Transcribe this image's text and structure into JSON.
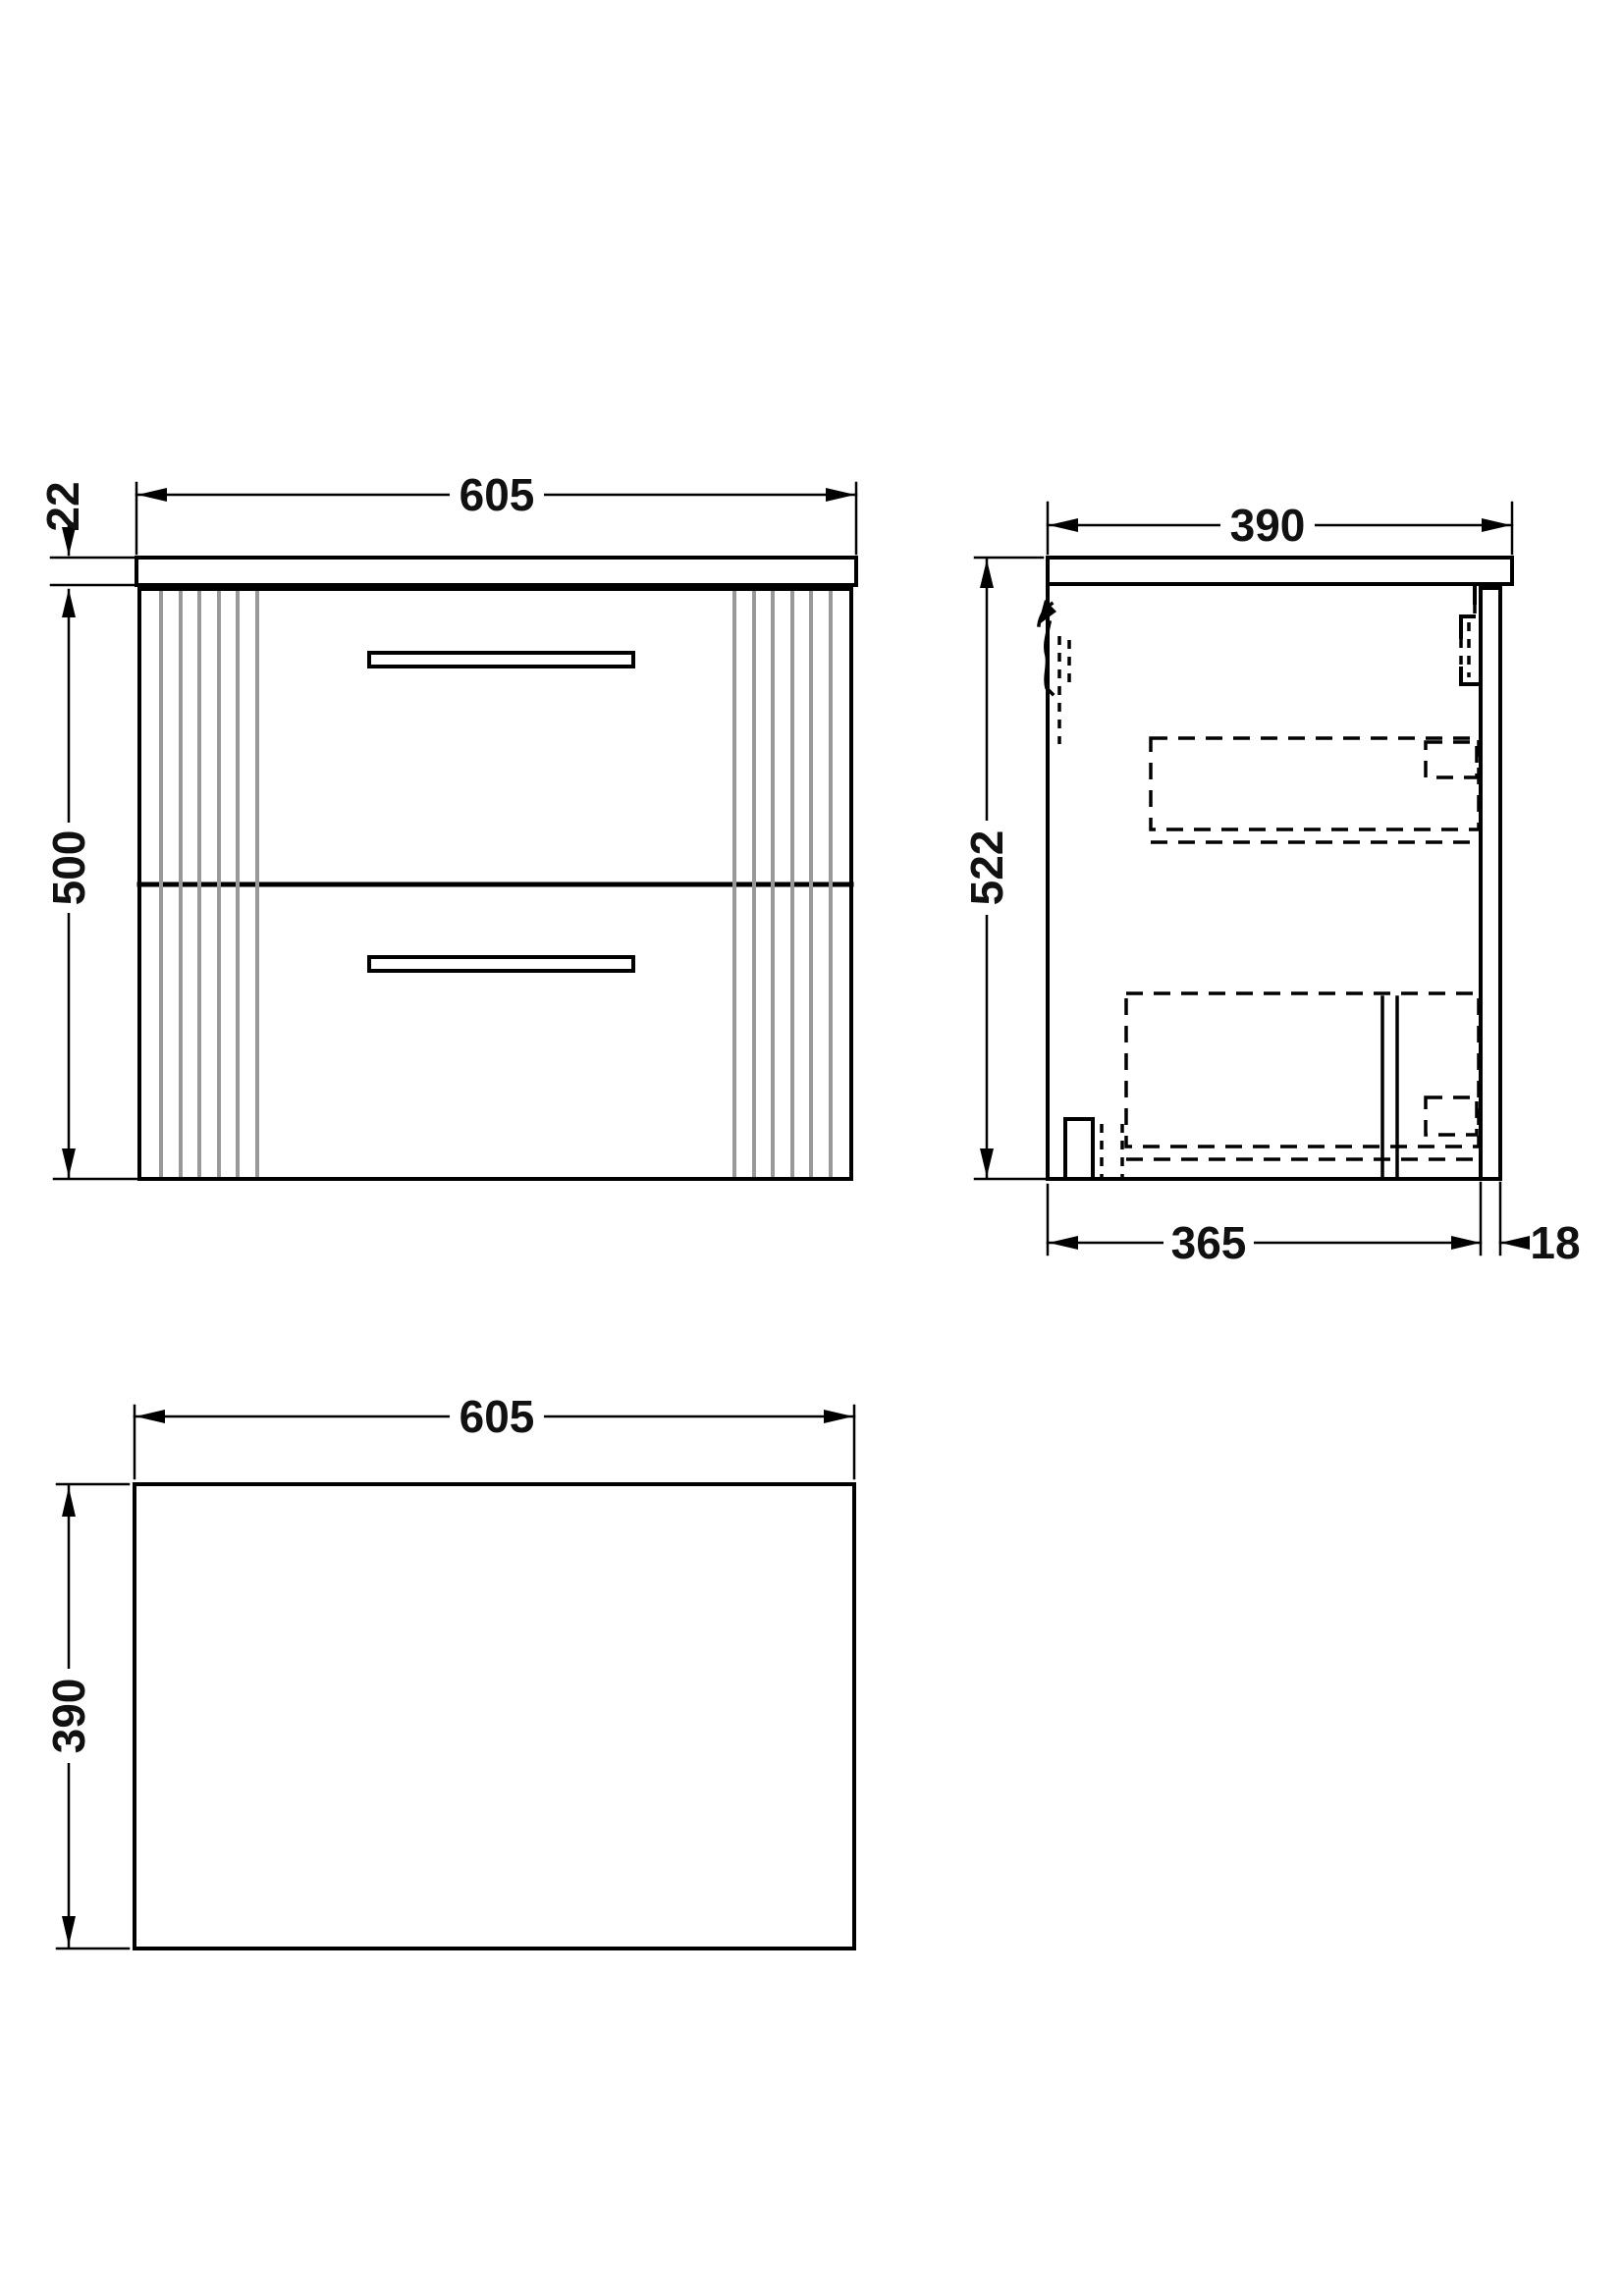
{
  "drawing": {
    "views": {
      "front": {
        "width_label": "605",
        "worktop_thickness_label": "22",
        "cabinet_height_label": "500"
      },
      "side": {
        "depth_label": "390",
        "overall_height_label": "522",
        "carcass_depth_label": "365",
        "back_panel_thickness_label": "18"
      },
      "plan": {
        "width_label": "605",
        "depth_label": "390"
      }
    },
    "colors": {
      "line": "#000000",
      "flute_line": "#999999",
      "background": "#ffffff",
      "dimension_text": "#111111"
    }
  }
}
